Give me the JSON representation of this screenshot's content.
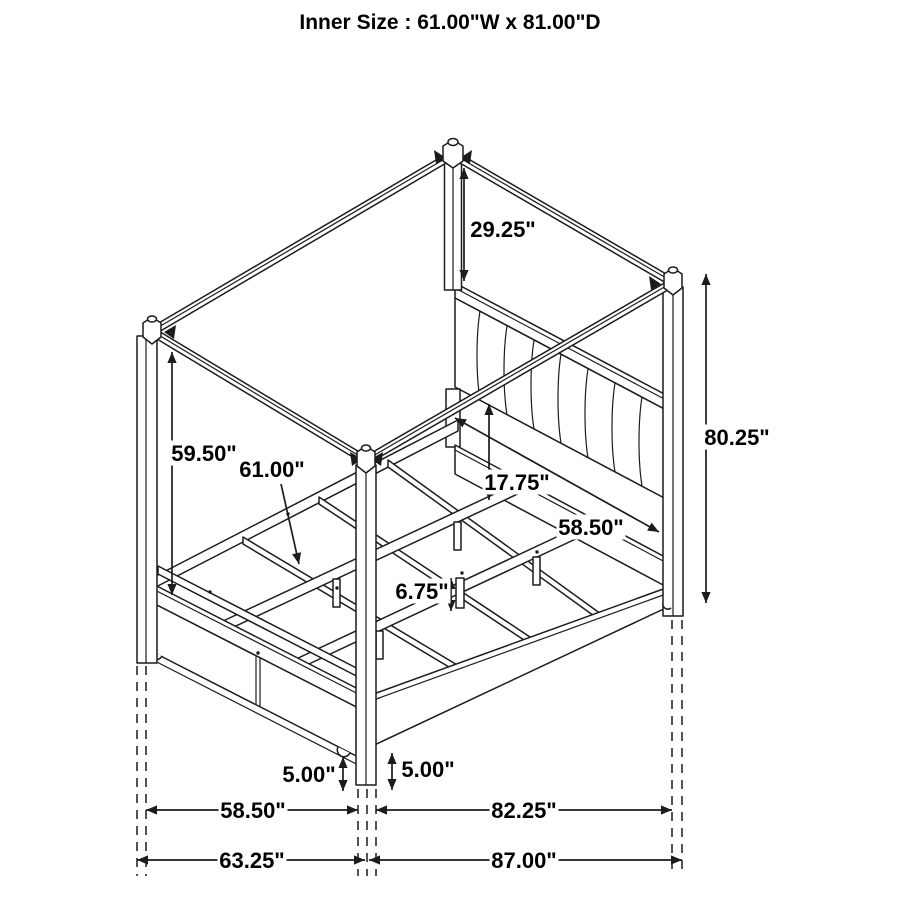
{
  "title": "Inner Size : 61.00\"W x 81.00\"D",
  "diagram": {
    "type": "isometric-line-drawing",
    "subject": "canopy storage bed with dimension callouts",
    "line_color": "#1c1c1c",
    "background_color": "#ffffff",
    "dimensions": [
      {
        "id": "canopy-to-headboard-height",
        "label": "29.25\"",
        "kind": "vertical",
        "x": 464,
        "y1": 168,
        "y2": 281,
        "lx": 503,
        "ly": 229
      },
      {
        "id": "overall-height",
        "label": "80.25\"",
        "kind": "vertical",
        "x": 706,
        "y1": 274,
        "y2": 603,
        "lx": 737,
        "ly": 437
      },
      {
        "id": "footboard-post-height",
        "label": "59.50\"",
        "kind": "vertical",
        "x": 172,
        "y1": 352,
        "y2": 595,
        "lx": 204,
        "ly": 453
      },
      {
        "id": "inner-slat-width",
        "label": "61.00\"",
        "kind": "leader",
        "x1": 281,
        "y1": 484,
        "x2": 299,
        "y2": 564,
        "lx": 272,
        "ly": 469
      },
      {
        "id": "headboard-panel-to-rail",
        "label": "17.75\"",
        "kind": "vertical",
        "x": 489,
        "y1": 404,
        "y2": 500,
        "lx": 517,
        "ly": 482
      },
      {
        "id": "inner-rail-length",
        "label": "58.50\"",
        "kind": "diag",
        "x1": 455,
        "y1": 418,
        "x2": 659,
        "y2": 532,
        "lx": 591,
        "ly": 527
      },
      {
        "id": "support-leg-height",
        "label": "6.75\"",
        "kind": "vertical",
        "x": 451,
        "y1": 578,
        "y2": 611,
        "lx": 422,
        "ly": 591
      },
      {
        "id": "clearance-left",
        "label": "5.00\"",
        "kind": "vertical",
        "x": 343,
        "y1": 757,
        "y2": 791,
        "lx": 309,
        "ly": 774
      },
      {
        "id": "clearance-right",
        "label": "5.00\"",
        "kind": "vertical",
        "x": 392,
        "y1": 753,
        "y2": 790,
        "lx": 428,
        "ly": 769
      },
      {
        "id": "footboard-width-inner",
        "label": "58.50\"",
        "kind": "horizontal",
        "y": 810,
        "x1": 146,
        "x2": 358,
        "lx": 253,
        "ly": 810
      },
      {
        "id": "side-length-inner",
        "label": "82.25\"",
        "kind": "horizontal",
        "y": 810,
        "x1": 376,
        "x2": 672,
        "lx": 524,
        "ly": 810
      },
      {
        "id": "footboard-width-overall",
        "label": "63.25\"",
        "kind": "horizontal",
        "y": 860,
        "x1": 137,
        "x2": 365,
        "lx": 252,
        "ly": 860
      },
      {
        "id": "overall-length",
        "label": "87.00\"",
        "kind": "horizontal",
        "y": 860,
        "x1": 369,
        "x2": 682,
        "lx": 524,
        "ly": 860
      }
    ]
  }
}
